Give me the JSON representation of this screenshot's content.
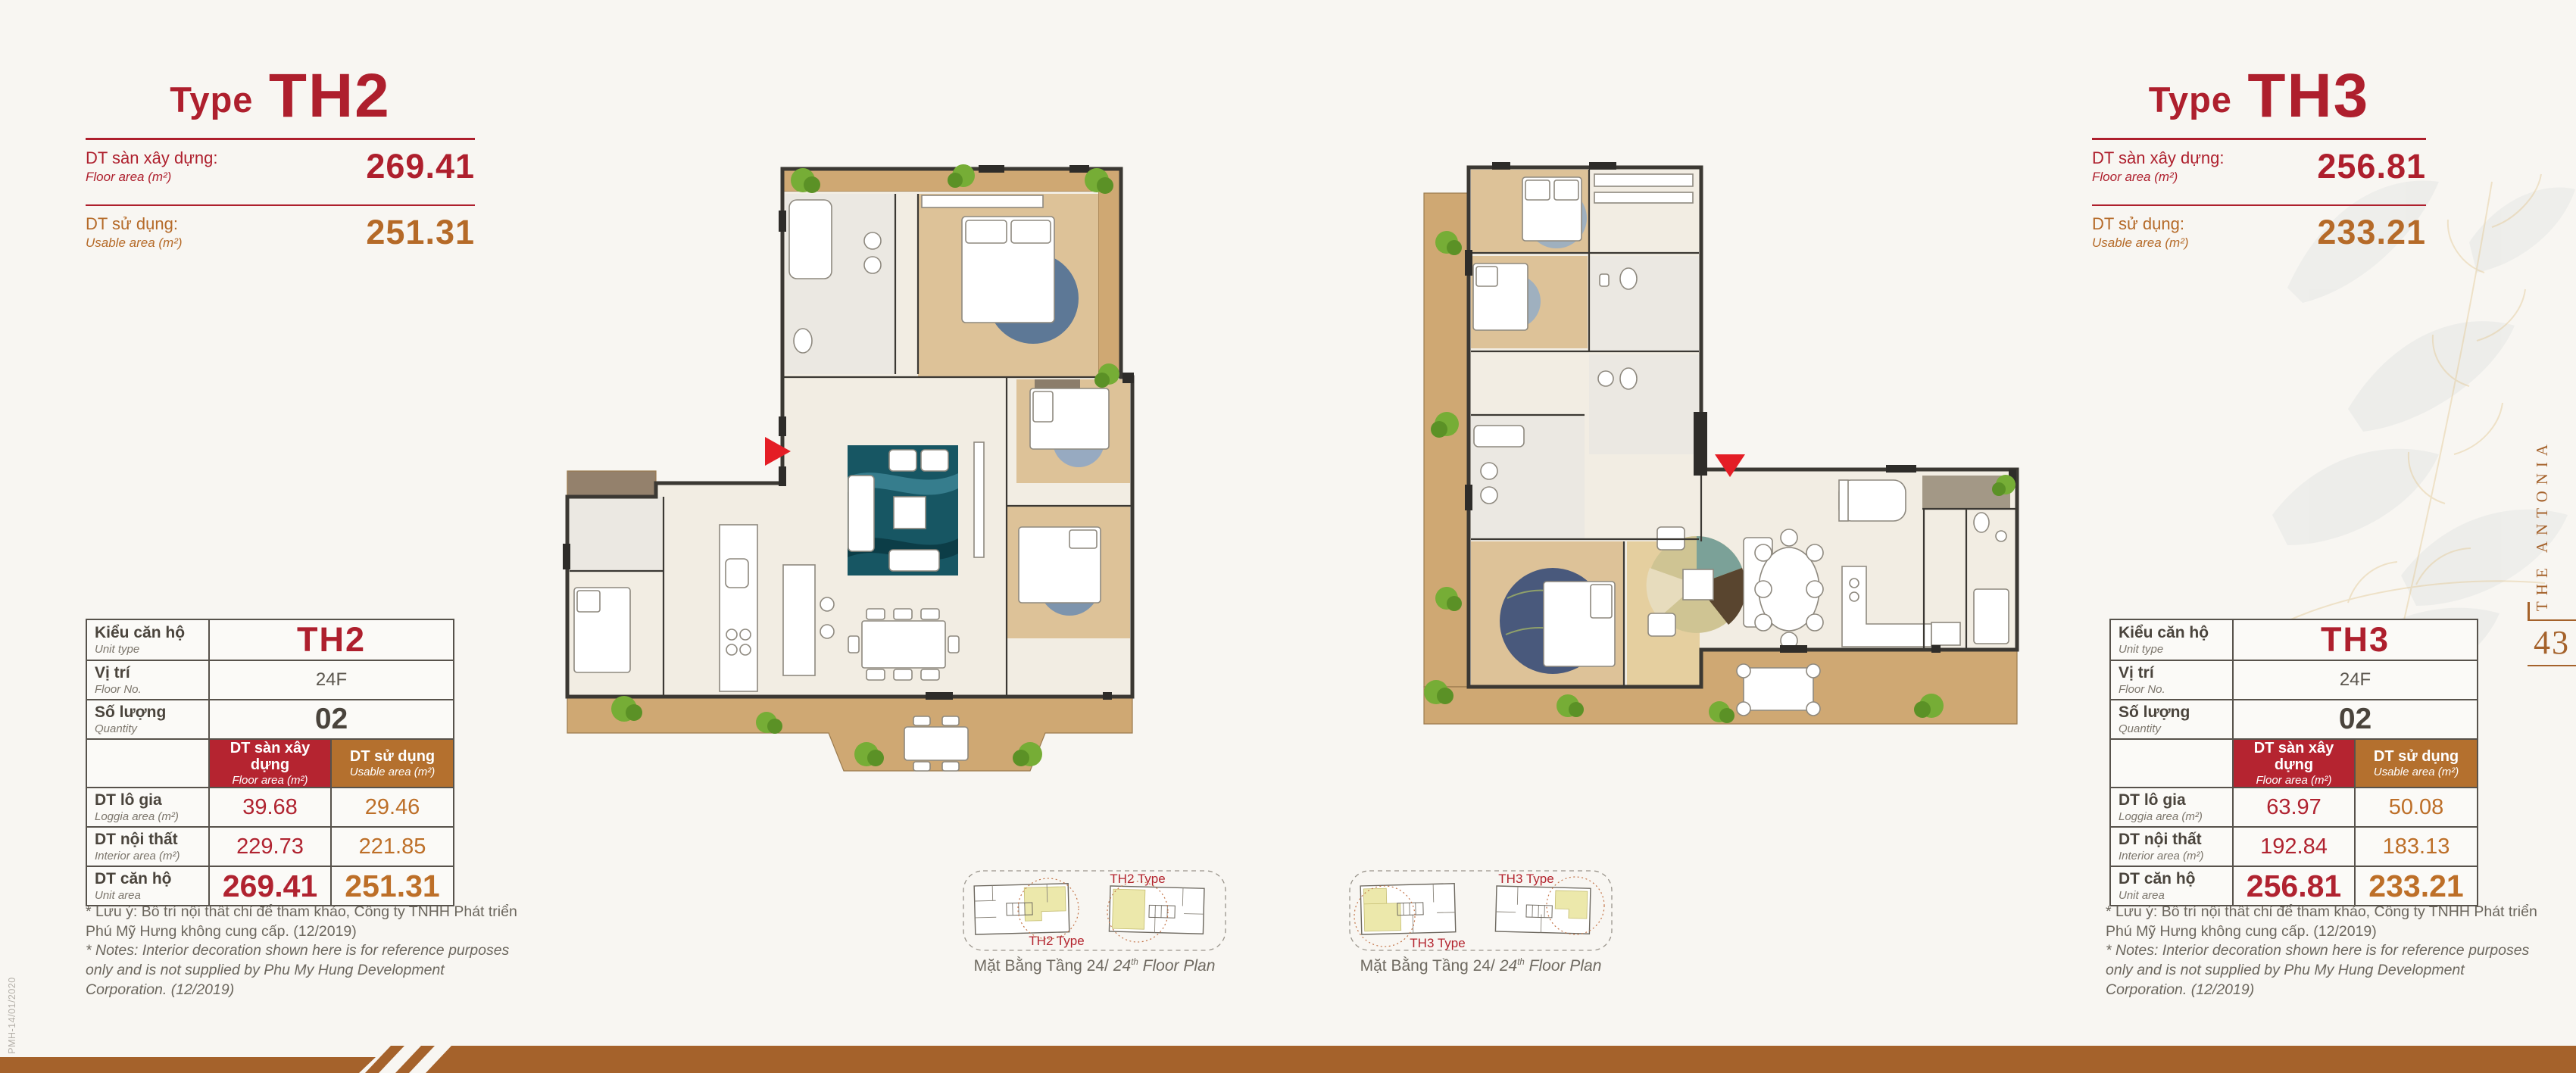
{
  "palette": {
    "accent_red": "#ae1f2d",
    "accent_brown": "#b56a28",
    "header_cell_red": "#b52430",
    "header_cell_brown": "#b4702e",
    "footer_band": "#a5622b"
  },
  "brand": {
    "name_vertical": "THE ANTONIA",
    "page_number": "43",
    "doc_code": "PMH-14/01/2020"
  },
  "shared": {
    "col_floor_vi": "DT sàn xây dựng",
    "col_floor_en": "Floor area (m²)",
    "col_usable_vi": "DT sử dụng",
    "col_usable_en": "Usable area (m²)"
  },
  "units": {
    "th2": {
      "title_prefix": "Type",
      "title_code": "TH2",
      "header": {
        "floor_label_vi": "DT sàn xây dựng:",
        "floor_label_en": "Floor area (m²)",
        "floor_value": "269.41",
        "usable_label_vi": "DT sử dụng:",
        "usable_label_en": "Usable area (m²)",
        "usable_value": "251.31"
      },
      "table": {
        "rows_info": [
          {
            "label_vi": "Kiểu căn hộ",
            "label_en": "Unit type",
            "value": "TH2"
          },
          {
            "label_vi": "Vị trí",
            "label_en": "Floor No.",
            "value": "24F"
          },
          {
            "label_vi": "Số lượng",
            "label_en": "Quantity",
            "value": "02"
          }
        ],
        "rows_area": [
          {
            "label_vi": "DT lô gia",
            "label_en": "Loggia area (m²)",
            "floor": "39.68",
            "usable": "29.46"
          },
          {
            "label_vi": "DT nội thất",
            "label_en": "Interior area (m²)",
            "floor": "229.73",
            "usable": "221.85"
          },
          {
            "label_vi": "DT căn hộ",
            "label_en": "Unit area",
            "floor": "269.41",
            "usable": "251.31"
          }
        ]
      },
      "notes_vi": "* Lưu ý: Bố trí nội thất chỉ để tham khảo, Công ty TNHH Phát triển Phú Mỹ Hưng không cung cấp. (12/2019)",
      "notes_en": "* Notes: Interior decoration shown here is for reference purposes only and is not supplied by Phu My Hung Development Corporation. (12/2019)",
      "keyplan": {
        "label_top": "TH2 Type",
        "label_bottom": "TH2 Type",
        "caption_vi": "Mặt Bằng Tầng 24/",
        "caption_en_num": "24",
        "caption_en_sup": "th",
        "caption_en_rest": " Floor Plan"
      }
    },
    "th3": {
      "title_prefix": "Type",
      "title_code": "TH3",
      "header": {
        "floor_label_vi": "DT sàn xây dựng:",
        "floor_label_en": "Floor area (m²)",
        "floor_value": "256.81",
        "usable_label_vi": "DT sử dụng:",
        "usable_label_en": "Usable area (m²)",
        "usable_value": "233.21"
      },
      "table": {
        "rows_info": [
          {
            "label_vi": "Kiểu căn hộ",
            "label_en": "Unit type",
            "value": "TH3"
          },
          {
            "label_vi": "Vị trí",
            "label_en": "Floor No.",
            "value": "24F"
          },
          {
            "label_vi": "Số lượng",
            "label_en": "Quantity",
            "value": "02"
          }
        ],
        "rows_area": [
          {
            "label_vi": "DT lô gia",
            "label_en": "Loggia area (m²)",
            "floor": "63.97",
            "usable": "50.08"
          },
          {
            "label_vi": "DT nội thất",
            "label_en": "Interior area (m²)",
            "floor": "192.84",
            "usable": "183.13"
          },
          {
            "label_vi": "DT căn hộ",
            "label_en": "Unit area",
            "floor": "256.81",
            "usable": "233.21"
          }
        ]
      },
      "notes_vi": "* Lưu ý: Bố trí nội thất chỉ để tham khảo, Công ty TNHH Phát triển Phú Mỹ Hưng không cung cấp. (12/2019)",
      "notes_en": "* Notes: Interior decoration shown here is for reference purposes only and is not supplied by Phu My Hung Development Corporation. (12/2019)",
      "keyplan": {
        "label_top": "TH3 Type",
        "label_bottom": "TH3 Type",
        "caption_vi": "Mặt Bằng Tầng 24/",
        "caption_en_num": "24",
        "caption_en_sup": "th",
        "caption_en_rest": " Floor Plan"
      }
    }
  }
}
